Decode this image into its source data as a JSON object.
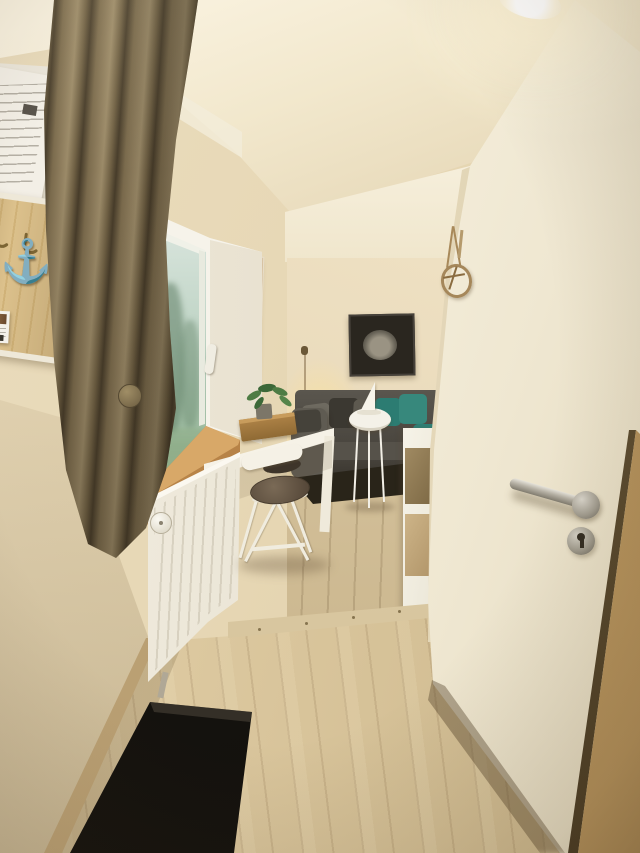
{
  "meta": {
    "description": "Interior photograph of a bright apartment hallway: an open cream door on the right with a stainless lever handle and keyhole, a curtained window above a white radiator on the left, a wooden coat rack with an anchor ornament and pinned info sheets, a black boot tray on light oak laminate flooring, and a view into a living room with a dark grey corner sofa, teal cushions, a framed boat photo, a glowing lamp, a white side table with a sailboat ornament, a white desk and folding chair, and a white shelf."
  },
  "palette": {
    "wall": "#e8d8b4",
    "ceiling": "#f5ecd6",
    "curtain": "#7c6c4e",
    "door": "#f4eedd",
    "door_jamb": "#c2a068",
    "hall_floor": "#d8c49c",
    "living_floor": "#d0bd96",
    "radiator": "#efe9dc",
    "window_view": "#b6cdbb",
    "windowsill": "#b5824a",
    "sofa": "#4e4b44",
    "teal_accent": "#2f8277",
    "rug": "#2a251c",
    "boot_tray": "#181510",
    "metal_hardware": "#aca69a",
    "rack_wood": "#d8bd8a",
    "canvas_art": "#c8ad88",
    "desk": "#f5f1e6"
  },
  "objects": {
    "ceiling_light": {
      "label": "ceiling light"
    },
    "open_door": {
      "label": "open white interior door"
    },
    "door_handle": {
      "label": "stainless steel lever door handle"
    },
    "keyhole": {
      "label": "round keyhole escutcheon"
    },
    "door_frame": {
      "label": "door frame edge"
    },
    "nautical_wreath": {
      "label": "nautical wreath ornament hanging on door frame"
    },
    "window": {
      "label": "white hallway window with garden view"
    },
    "window_handle": {
      "label": "white window handle"
    },
    "curtain": {
      "label": "olive-brown curtain with tieback"
    },
    "windowsill": {
      "label": "wooden windowsill"
    },
    "radiator": {
      "label": "white panel radiator with thermostat valve"
    },
    "beach_canvas": {
      "label": "tall sand-toned canvas print"
    },
    "coat_rack": {
      "label": "wooden coat rack board with hooks",
      "anchor_icon": "⚓"
    },
    "info_sheets": {
      "label": "pinned information sheets",
      "text": "illegible"
    },
    "info_card": {
      "label": "small info card with photo and QR code",
      "text": "illegible"
    },
    "boot_tray": {
      "label": "black rubber boot tray"
    },
    "hall_floor": {
      "label": "light oak laminate hallway floor"
    },
    "threshold": {
      "label": "floor threshold strip with screws"
    },
    "living_room": {
      "label": "living room beyond open doorway"
    },
    "sofa": {
      "label": "dark grey corner sofa with grey and teal cushions"
    },
    "wall_picture": {
      "label": "framed black and white boat photograph"
    },
    "lamp": {
      "label": "warm glowing lamp"
    },
    "side_table": {
      "label": "white round side table"
    },
    "sailboat_ornament": {
      "label": "white sailboat ornament"
    },
    "rug": {
      "label": "dark area rug"
    },
    "shelf": {
      "label": "white shelf unit behind door"
    },
    "desk": {
      "label": "white desk"
    },
    "desk_tray": {
      "label": "wooden serving tray"
    },
    "plant": {
      "label": "small green potted plant"
    },
    "chair": {
      "label": "white folding chair with brown seat cushion"
    }
  }
}
